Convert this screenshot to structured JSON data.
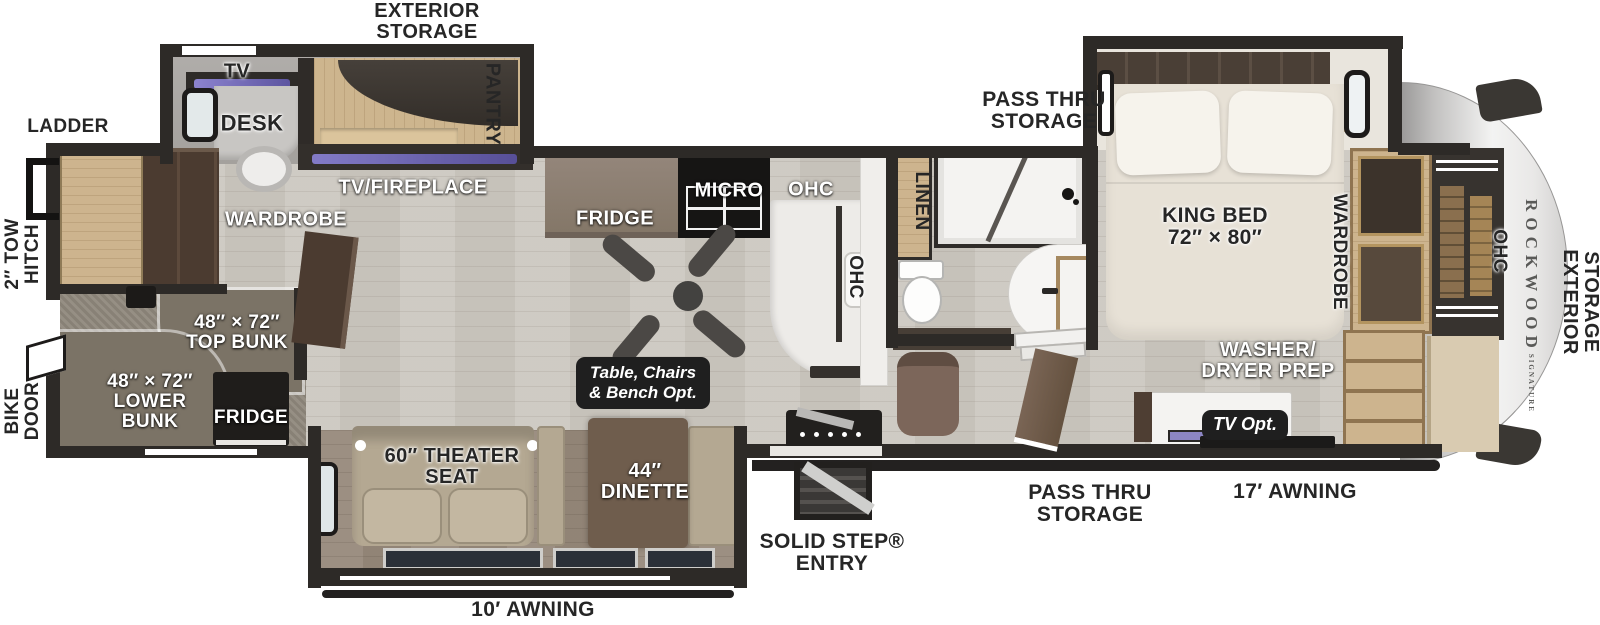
{
  "palette": {
    "wall": "#2d2a27",
    "floor_wood": "#cbc7bf",
    "floor_theater": "#97897b",
    "carpet": "#90897d",
    "tan_wood": "#cdb48e",
    "dark_wood": "#4b3b30",
    "counter": "#edebe8",
    "tv_accent": "#837bc7",
    "badge_bg": "#1f1f1f",
    "cap_gray": "#c9c8c7"
  },
  "labels": {
    "exterior_storage_top": [
      "EXTERIOR",
      "STORAGE"
    ],
    "ladder": "LADDER",
    "tow_hitch": [
      "2″ TOW",
      "HITCH"
    ],
    "bike_door": [
      "BIKE",
      "DOOR"
    ],
    "tv": "TV",
    "desk": "DESK",
    "pantry": "PANTRY",
    "tv_fireplace": "TV/FIREPLACE",
    "wardrobe_left": "WARDROBE",
    "top_bunk": [
      "48″ × 72″",
      "TOP BUNK"
    ],
    "lower_bunk": [
      "48″ × 72″",
      "LOWER",
      "BUNK"
    ],
    "fridge_bunk": "FRIDGE",
    "fridge": "FRIDGE",
    "micro": "MICRO",
    "ohc_kitchen": "OHC",
    "ohc_island": "OHC",
    "table_opt": [
      "Table, Chairs",
      "& Bench Opt."
    ],
    "linen": "LINEN",
    "pass_thru_top": [
      "PASS THRU",
      "STORAGE"
    ],
    "king_bed": [
      "KING BED",
      "72″ × 80″"
    ],
    "wardrobe_right": "WARDROBE",
    "washer_dryer": [
      "WASHER/",
      "DRYER PREP"
    ],
    "tv_opt": "TV Opt.",
    "ohc_front": "OHC",
    "brand": "ROCKWOOD",
    "brand_sub": "SIGNATURE",
    "exterior_storage_right": [
      "EXTERIOR",
      "STORAGE"
    ],
    "theater_seat": [
      "60″ THEATER",
      "SEAT"
    ],
    "dinette": [
      "44″",
      "DINETTE"
    ],
    "solid_step": [
      "SOLID STEP®",
      "ENTRY"
    ],
    "pass_thru_bottom": [
      "PASS THRU",
      "STORAGE"
    ],
    "awning_17": "17′ AWNING",
    "awning_10": "10′ AWNING"
  }
}
